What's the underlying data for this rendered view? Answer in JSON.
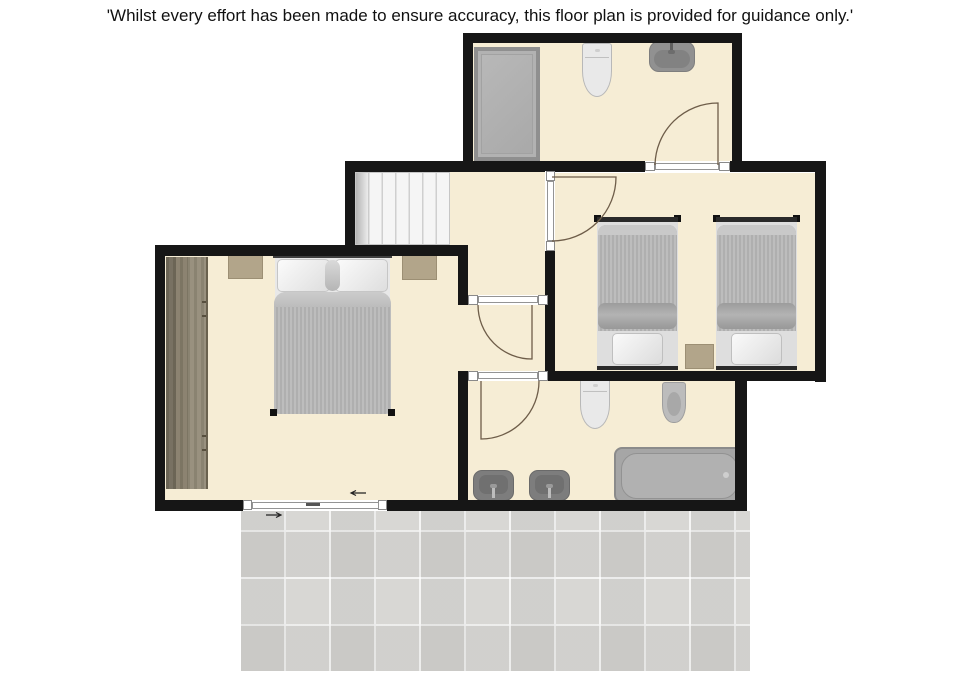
{
  "disclaimer": "'Whilst every effort has been made to ensure accuracy, this floor plan is provided for guidance only.'",
  "palette": {
    "floor": "#f6edd5",
    "wall": "#161616",
    "terrace_tile": "#d8d7d4",
    "fixture_dark_gray": "#7d7d7d",
    "fixture_mid_gray": "#a6a6a6",
    "duvet_gray": "#b6b6b6",
    "wood_wardrobe": "#8d8470",
    "accent_tan": "#b2a58a",
    "door_arc": "#6e5d49"
  },
  "floorplan": {
    "rooms": [
      {
        "name": "shower-room",
        "fixtures": [
          "shower-enclosure",
          "toilet",
          "basin"
        ]
      },
      {
        "name": "landing",
        "fixtures": [
          "staircase"
        ]
      },
      {
        "name": "twin-bedroom",
        "fixtures": [
          "single-bed",
          "single-bed",
          "nightstand"
        ]
      },
      {
        "name": "double-bedroom",
        "fixtures": [
          "wardrobe",
          "double-bed",
          "bedside-table",
          "bedside-table"
        ]
      },
      {
        "name": "bathroom",
        "fixtures": [
          "toilet",
          "bidet",
          "basin",
          "basin",
          "bathtub"
        ]
      },
      {
        "name": "terrace",
        "fixtures": []
      }
    ],
    "doors": {
      "hinged_count": 4,
      "sliding_count": 1,
      "open_doorway_count": 1
    }
  }
}
